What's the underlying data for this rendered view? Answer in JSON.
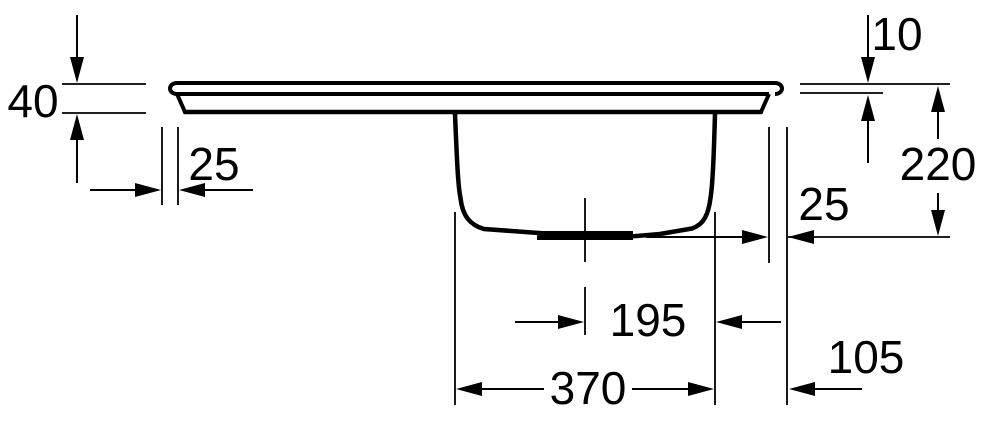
{
  "drawing": {
    "type": "technical-dimension-drawing",
    "subject": "Built-in sink side elevation with bowl, drain centerline and dimension annotations",
    "line_color": "#000000",
    "background_color": "#ffffff",
    "dimensions": {
      "rim_profile_height": {
        "value": "40",
        "orientation": "vertical",
        "measures": "overall height of rim edge profile"
      },
      "rim_lip_thickness": {
        "value": "10",
        "orientation": "vertical",
        "measures": "thickness of top rim lip"
      },
      "left_edge_overhang": {
        "value": "25",
        "orientation": "horizontal",
        "measures": "left rim edge overhang"
      },
      "bowl_depth": {
        "value": "220",
        "orientation": "vertical",
        "measures": "depth from rim top to bowl bottom"
      },
      "right_edge_overhang": {
        "value": "25",
        "orientation": "horizontal",
        "measures": "right rim edge overhang"
      },
      "drain_center_to_bowl_right": {
        "value": "195",
        "orientation": "horizontal",
        "measures": "drain centerline to right bowl wall"
      },
      "bowl_width": {
        "value": "370",
        "orientation": "horizontal",
        "measures": "bowl opening width"
      },
      "bowl_right_to_rim_edge": {
        "value": "105",
        "orientation": "horizontal",
        "measures": "right bowl wall to outer rim edge"
      }
    }
  }
}
